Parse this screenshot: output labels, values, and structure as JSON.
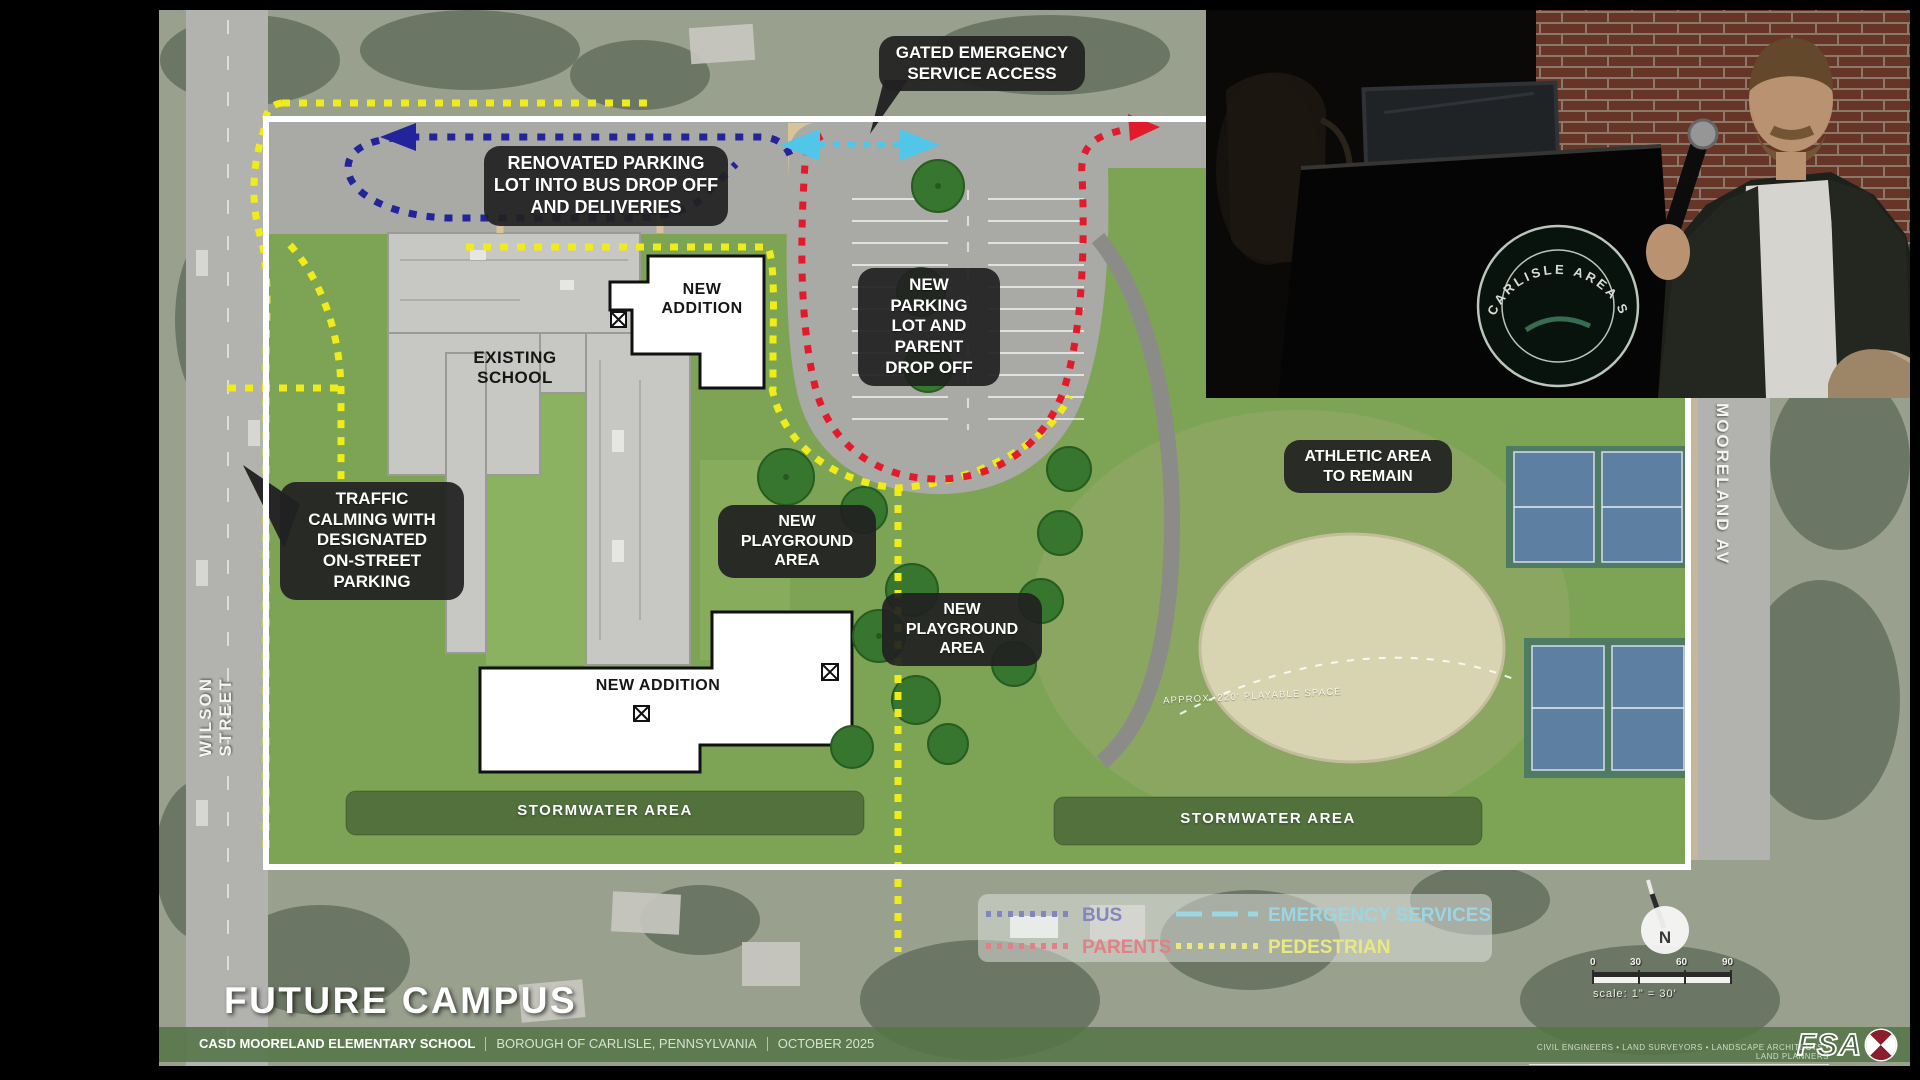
{
  "title": "FUTURE CAMPUS",
  "callouts": {
    "gated_emergency": "GATED EMERGENCY\nSERVICE ACCESS",
    "renovated_parking": "RENOVATED PARKING\nLOT INTO BUS DROP OFF\nAND DELIVERIES",
    "new_parking": "NEW\nPARKING\nLOT AND\nPARENT\nDROP OFF",
    "athletic": "ATHLETIC AREA\nTO REMAIN",
    "traffic_calming": "TRAFFIC\nCALMING WITH\nDESIGNATED\nON-STREET\nPARKING",
    "playground_1": "NEW\nPLAYGROUND\nAREA",
    "playground_2": "NEW\nPLAYGROUND\nAREA"
  },
  "buildings": {
    "existing_school": "EXISTING\nSCHOOL",
    "new_addition_top": "NEW\nADDITION",
    "new_addition_bottom": "NEW ADDITION"
  },
  "areas": {
    "stormwater_left": "STORMWATER AREA",
    "stormwater_right": "STORMWATER AREA",
    "field_note": "APPROX. 220' PLAYABLE SPACE"
  },
  "streets": {
    "wilson": "WILSON STREET",
    "mooreland": "MOORELAND AV"
  },
  "routes": {
    "bus": {
      "label": "BUS",
      "color": "#23249c"
    },
    "parents": {
      "label": "PARENTS",
      "color": "#e31a2c"
    },
    "emergency": {
      "label": "EMERGENCY SERVICES",
      "color": "#52c6e8"
    },
    "pedestrian": {
      "label": "PEDESTRIAN",
      "color": "#f0ec1a"
    }
  },
  "compass": {
    "label": "N"
  },
  "scalebar": {
    "ticks": [
      "0",
      "30",
      "60",
      "90"
    ],
    "caption": "scale: 1\" = 30'"
  },
  "footer": {
    "school": "CASD MOORELAND ELEMENTARY SCHOOL",
    "location": "BOROUGH OF CARLISLE, PENNSYLVANIA",
    "date": "OCTOBER 2025",
    "firm_tagline": "CIVIL ENGINEERS • LAND SURVEYORS • LANDSCAPE ARCHITECTS • LAND PLANNERS",
    "firm": "FSA"
  },
  "webcam": {
    "seal_text": "CARLISLE AREA SCH"
  }
}
